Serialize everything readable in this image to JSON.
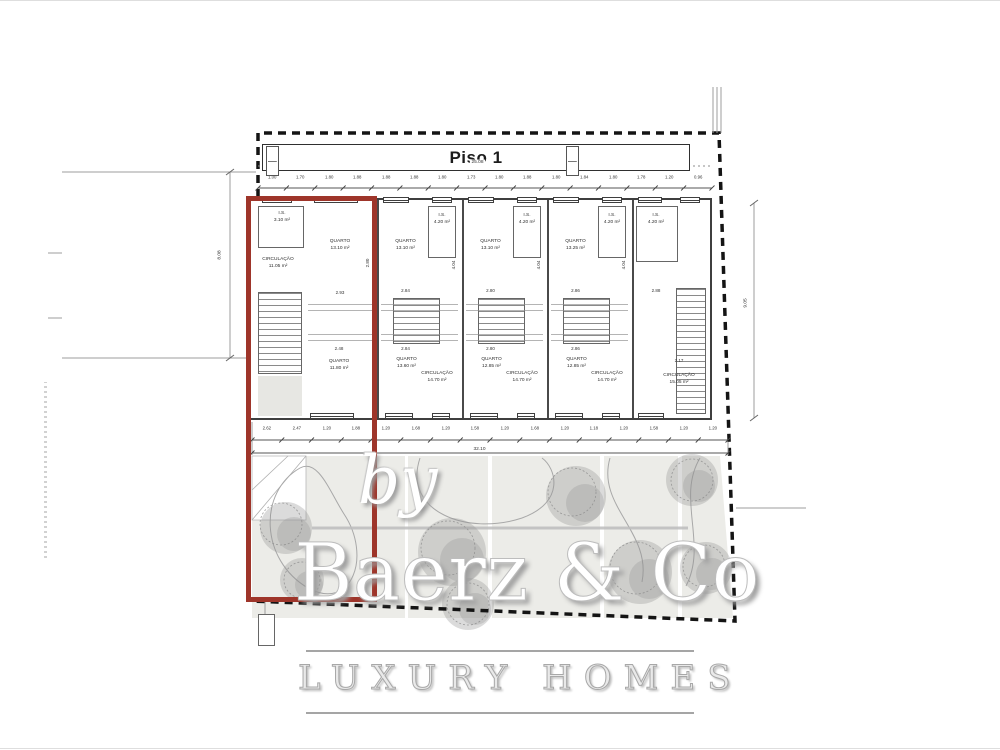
{
  "title": "Piso 1",
  "dimensions": {
    "top_total": "25.08",
    "top_segments": [
      "1.00",
      "1.70",
      "1.80",
      "1.88",
      "1.88",
      "1.88",
      "1.80",
      "1.73",
      "1.80",
      "1.88",
      "1.80",
      "1.84",
      "1.80",
      "1.78",
      "1.20",
      "0.96"
    ],
    "bottom_total": "32.10",
    "bottom_segments": [
      "2.62",
      "2.47",
      "1.20",
      "1.88",
      "1.20",
      "1.68",
      "1.20",
      "1.58",
      "1.20",
      "1.68",
      "1.20",
      "1.18",
      "1.20",
      "1.58",
      "1.20",
      "1.20"
    ],
    "left_height": "8.08",
    "right_height": "9.05"
  },
  "units": [
    {
      "label": "unit-1",
      "highlighted": true,
      "rooms": [
        {
          "name": "I.S.",
          "area": "3.10 m²"
        },
        {
          "name": "QUARTO",
          "area": "13.10 m²"
        },
        {
          "name": "CIRCULAÇÃO",
          "area": "11.05 m²"
        },
        {
          "name": "QUARTO",
          "area": "11.80 m²"
        }
      ],
      "dims": {
        "top": "2.93",
        "bottom": "2.48",
        "height": "2.80"
      }
    },
    {
      "label": "unit-2",
      "highlighted": false,
      "rooms": [
        {
          "name": "QUARTO",
          "area": "13.10 m²"
        },
        {
          "name": "I.S.",
          "area": "4.20 m²"
        },
        {
          "name": "QUARTO",
          "area": "13.60 m²"
        },
        {
          "name": "CIRCULAÇÃO",
          "area": "14.70 m²"
        }
      ],
      "dims": {
        "top": "2.84",
        "bottom": "2.84",
        "height": "4.04"
      }
    },
    {
      "label": "unit-3",
      "highlighted": false,
      "rooms": [
        {
          "name": "QUARTO",
          "area": "13.10 m²"
        },
        {
          "name": "I.S.",
          "area": "4.20 m²"
        },
        {
          "name": "QUARTO",
          "area": "12.85 m²"
        },
        {
          "name": "CIRCULAÇÃO",
          "area": "14.70 m²"
        }
      ],
      "dims": {
        "top": "2.80",
        "bottom": "2.80",
        "height": "4.04"
      }
    },
    {
      "label": "unit-4",
      "highlighted": false,
      "rooms": [
        {
          "name": "QUARTO",
          "area": "13.25 m²"
        },
        {
          "name": "I.S.",
          "area": "4.20 m²"
        },
        {
          "name": "QUARTO",
          "area": "12.85 m²"
        },
        {
          "name": "CIRCULAÇÃO",
          "area": "14.70 m²"
        }
      ],
      "dims": {
        "top": "2.86",
        "bottom": "2.86",
        "height": "4.04"
      }
    },
    {
      "label": "unit-5",
      "highlighted": false,
      "rooms": [
        {
          "name": "I.S.",
          "area": "4.20 m²"
        },
        {
          "name": "CIRCULAÇÃO",
          "area": "15.05 m²"
        }
      ],
      "dims": {
        "top": "2.88",
        "bottom": "2.17",
        "height": "2.17"
      }
    }
  ],
  "watermark": {
    "by": "by",
    "brand": "Baerz & Co",
    "tagline": "LUXURY HOMES"
  },
  "colors": {
    "highlight": "#9E352A",
    "boundary": "#141414",
    "garden": "#ECECE8",
    "tree": "#8F8F8F",
    "line": "#3F3F3F",
    "watermark": "#BDBDBD"
  }
}
